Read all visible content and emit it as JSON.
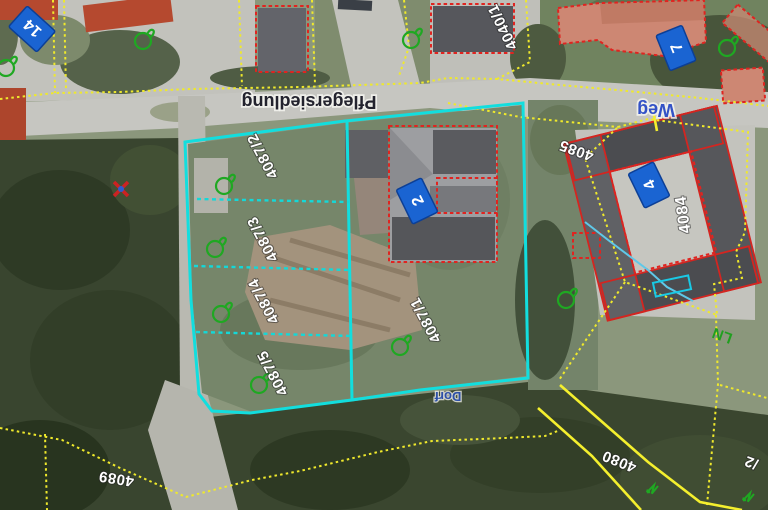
{
  "map": {
    "type": "cadastral-aerial-view",
    "street_labels": [
      {
        "text": "Pflegersiedlung",
        "color": "#23232e",
        "rotation_deg": 180
      },
      {
        "text": "Weg",
        "color": "#3352c6",
        "rotation_deg": 180
      },
      {
        "text": "Dorf",
        "color": "#2b50b4",
        "rotation_deg": 180
      }
    ],
    "parcel_labels": [
      {
        "text": "4040/1"
      },
      {
        "text": "4087/2"
      },
      {
        "text": "4087/3"
      },
      {
        "text": "4087/4"
      },
      {
        "text": "4087/5"
      },
      {
        "text": "4087/1"
      },
      {
        "text": "4084"
      },
      {
        "text": "4085"
      },
      {
        "text": "4080"
      },
      {
        "text": "4089"
      },
      {
        "text": "/2"
      }
    ],
    "house_numbers": [
      {
        "text": "14"
      },
      {
        "text": "7"
      },
      {
        "text": "2"
      },
      {
        "text": "4"
      }
    ],
    "landuse_labels": [
      {
        "text": "LN",
        "color": "#16a016"
      }
    ],
    "legend_colors": {
      "parcel_boundary": "#efe92c",
      "selected_parcels": "#12dede",
      "building_outline": "#e02420",
      "house_number_plate": "#1a64d2",
      "vegetation_symbol": "#1fa822",
      "water_line": "#5fc8e8",
      "parcel_number_text": "#ffffff"
    }
  }
}
